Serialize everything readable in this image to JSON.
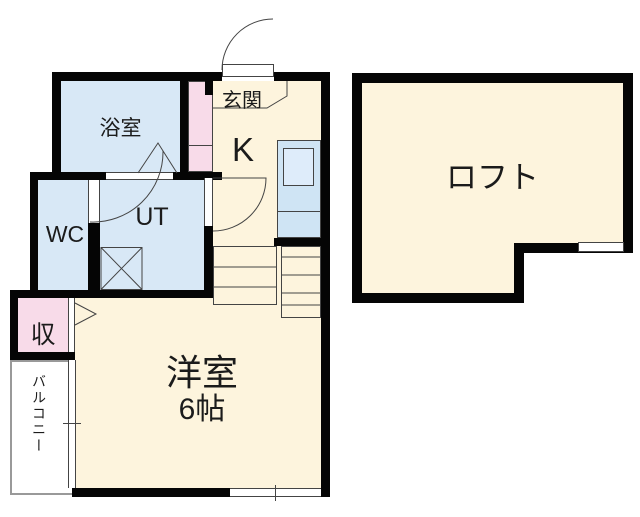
{
  "title": "間取り図",
  "colors": {
    "background": "#ffffff",
    "wall": "#050505",
    "cream": "#fdf4dd",
    "blue": "#d8e8f6",
    "pink": "#f8dbe9",
    "line": "#444444",
    "balcony_border": "#999999"
  },
  "rooms": {
    "bathroom": {
      "label": "浴室"
    },
    "entrance": {
      "label": "玄関"
    },
    "kitchen": {
      "label": "K"
    },
    "wc": {
      "label": "WC"
    },
    "utility": {
      "label": "UT"
    },
    "storage": {
      "label": "収"
    },
    "balcony": {
      "label": "バルコニー"
    },
    "western_room": {
      "label": "洋室",
      "size": "6帖"
    },
    "loft": {
      "label": "ロフト"
    }
  }
}
